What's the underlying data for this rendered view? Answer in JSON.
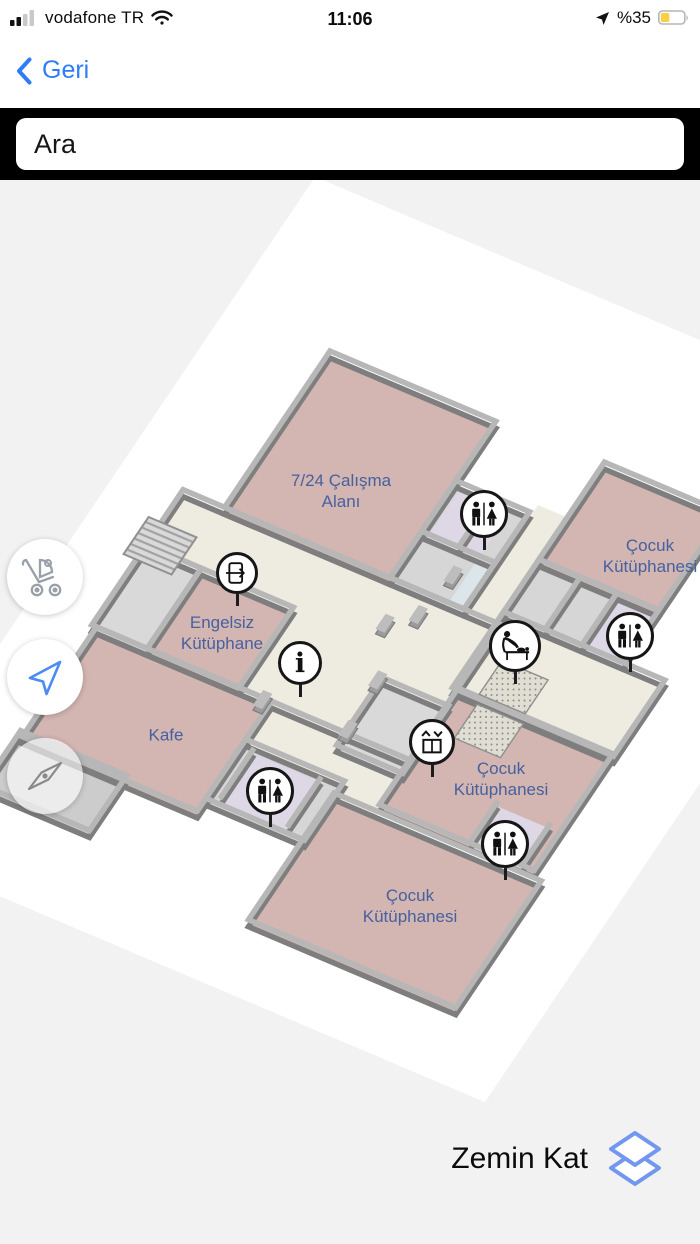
{
  "status_bar": {
    "carrier": "vodafone TR",
    "time": "11:06",
    "battery_percent": "%35",
    "icons": [
      "cellular-signal-icon",
      "wifi-icon",
      "location-arrow-icon",
      "battery-icon"
    ]
  },
  "nav_bar": {
    "back_label": "Geri"
  },
  "search": {
    "value": "Ara"
  },
  "map": {
    "room_labels": [
      {
        "id": "study-area",
        "text": "7/24 Çalışma\nAlanı"
      },
      {
        "id": "children-ne",
        "text": "Çocuk\nKütüphanesi"
      },
      {
        "id": "accessible-lib",
        "text": "Engelsiz\nKütüphane"
      },
      {
        "id": "cafe",
        "text": "Kafe"
      },
      {
        "id": "children-mid",
        "text": "Çocuk\nKütüphanesi"
      },
      {
        "id": "children-south",
        "text": "Çocuk\nKütüphanesi"
      }
    ],
    "markers": [
      {
        "icon": "wc-icon"
      },
      {
        "icon": "wc-icon"
      },
      {
        "icon": "wc-icon"
      },
      {
        "icon": "wc-icon"
      },
      {
        "icon": "exit-icon"
      },
      {
        "icon": "info-icon"
      },
      {
        "icon": "baby-care-icon"
      },
      {
        "icon": "elevator-icon"
      }
    ]
  },
  "side_buttons": [
    {
      "icon": "stroller-icon"
    },
    {
      "icon": "my-location-icon"
    },
    {
      "icon": "compass-icon"
    }
  ],
  "floor_switcher": {
    "current_floor": "Zemin Kat",
    "icon": "layers-icon"
  },
  "colors": {
    "accent_blue": "#2e7cf7",
    "room_pink": "#d3b5b1",
    "hall_cream": "#eeebe0",
    "label_blue": "#46619f",
    "battery_yellow": "#f8cf46",
    "layers_icon_blue": "#7197ee"
  }
}
